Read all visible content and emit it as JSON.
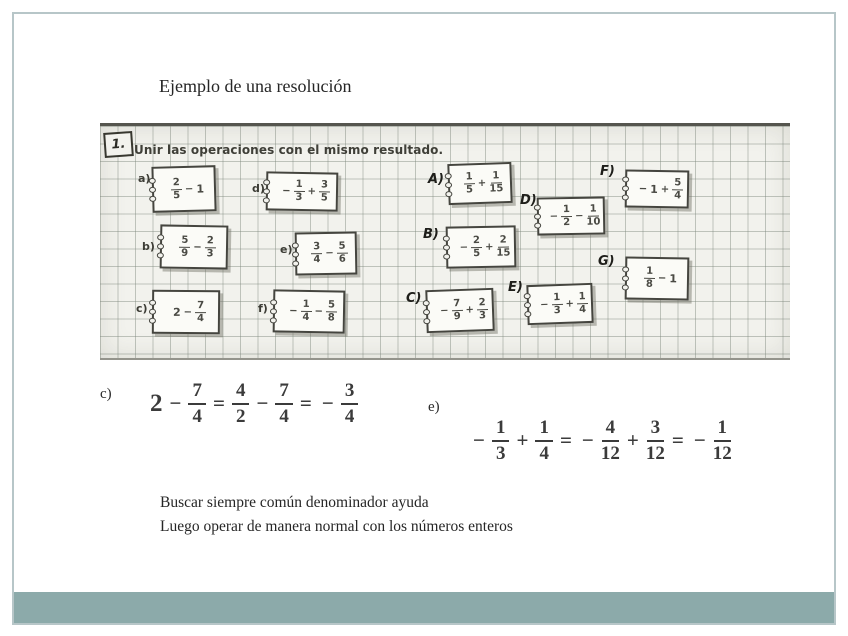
{
  "slide": {
    "title": "Ejemplo de una resolución",
    "accent_color": "#8caaaa",
    "border_color": "#b7c6c8"
  },
  "worksheet": {
    "exercise_number": "1.",
    "instruction": "Unir las operaciones con el mismo resultado.",
    "left_cards": [
      {
        "label": "a)",
        "expr": "2/5 − 1"
      },
      {
        "label": "d)",
        "expr": "− 1/3 + 3/5"
      },
      {
        "label": "b)",
        "expr": "5/9 − 2/3"
      },
      {
        "label": "e)",
        "expr": "3/4 − 5/6"
      },
      {
        "label": "c)",
        "expr": "2 − 7/4"
      },
      {
        "label": "f)",
        "expr": "− 1/4 − 5/8"
      }
    ],
    "right_cards": [
      {
        "label": "A)",
        "expr": "1/5 + 1/15"
      },
      {
        "label": "D)",
        "expr": "− 1/2 − 1/10"
      },
      {
        "label": "F)",
        "expr": "− 1 + 5/4"
      },
      {
        "label": "B)",
        "expr": "− 2/5 + 2/15"
      },
      {
        "label": "G)",
        "expr": "1/8 − 1"
      },
      {
        "label": "E)",
        "expr": "− 1/3 + 1/4"
      },
      {
        "label": "C)",
        "expr": "− 7/9 + 2/3"
      }
    ]
  },
  "solutions": [
    {
      "label": "c)",
      "expr": "2 − 7/4 = 4/2 − 7/4 = − 3/4"
    },
    {
      "label": "e)",
      "expr": "− 1/3 + 1/4 = − 4/12 + 3/12 = − 1/12"
    }
  ],
  "notes": [
    "Buscar siempre común denominador ayuda",
    "Luego operar de manera normal con los números enteros"
  ]
}
